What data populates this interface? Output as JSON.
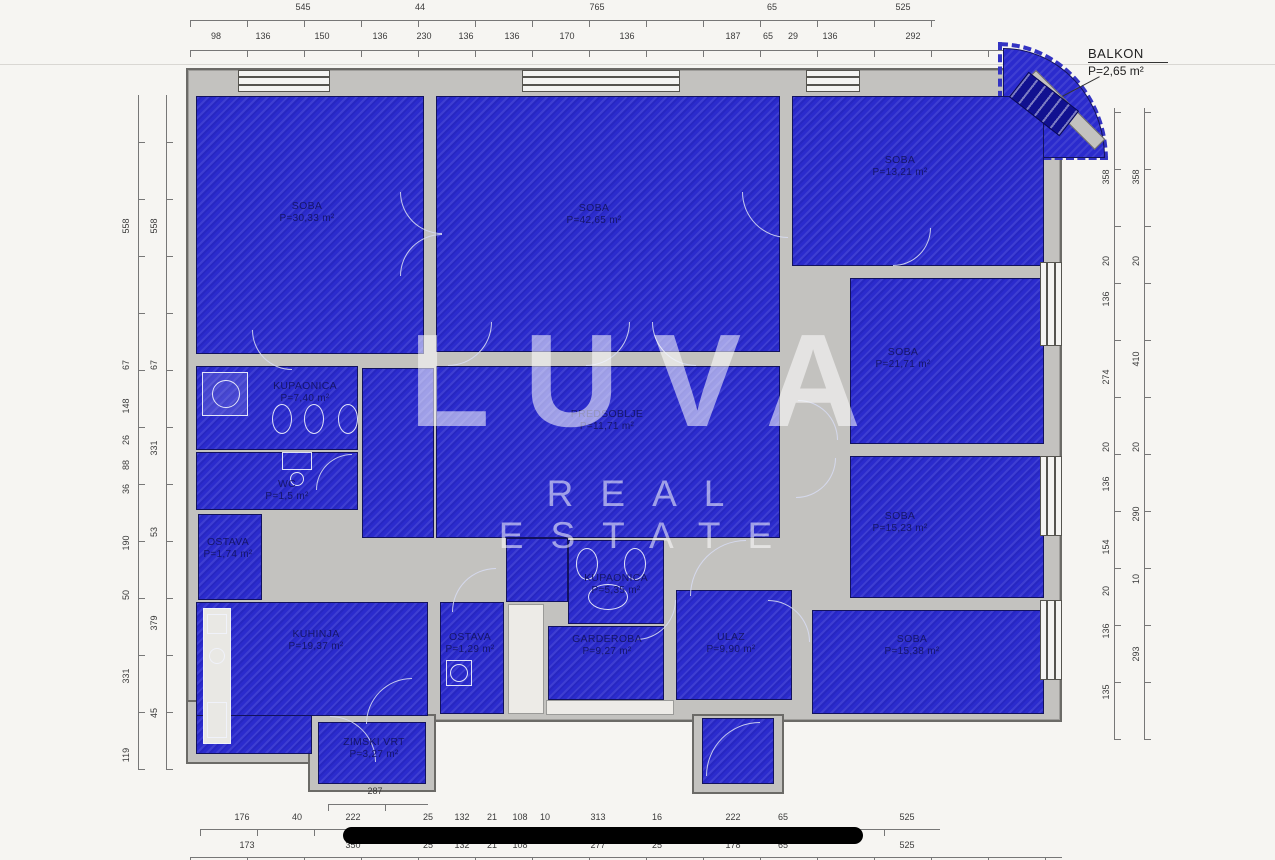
{
  "watermark": {
    "line1": "LUVA",
    "line2": "REAL ESTATE"
  },
  "balkon": {
    "name": "BALKON",
    "area": "P=2,65 m²"
  },
  "colors": {
    "room_blue": "#2b2bcd",
    "wall_gray": "#c3c2bf",
    "label_navy": "#15156a",
    "dim_text": "#3a3a3a",
    "bar_black": "#000000"
  },
  "rooms": [
    {
      "id": "soba-1",
      "name": "SOBA",
      "area": "P=30,33 m²",
      "x": 196,
      "y": 96,
      "w": 228,
      "h": 258,
      "lx": 307,
      "ly": 212
    },
    {
      "id": "soba-2",
      "name": "SOBA",
      "area": "P=42,65 m²",
      "x": 436,
      "y": 96,
      "w": 344,
      "h": 256,
      "lx": 594,
      "ly": 214
    },
    {
      "id": "soba-3",
      "name": "SOBA",
      "area": "P=13,21 m²",
      "x": 792,
      "y": 96,
      "w": 252,
      "h": 170,
      "lx": 900,
      "ly": 166
    },
    {
      "id": "soba-4",
      "name": "SOBA",
      "area": "P=21,71 m²",
      "x": 850,
      "y": 278,
      "w": 194,
      "h": 166,
      "lx": 903,
      "ly": 358
    },
    {
      "id": "soba-5",
      "name": "SOBA",
      "area": "P=15,23 m²",
      "x": 850,
      "y": 456,
      "w": 194,
      "h": 142,
      "lx": 900,
      "ly": 522
    },
    {
      "id": "soba-6",
      "name": "SOBA",
      "area": "P=15,38 m²",
      "x": 812,
      "y": 610,
      "w": 232,
      "h": 104,
      "lx": 912,
      "ly": 645
    },
    {
      "id": "predsoblje",
      "name": "PREDSOBLJE",
      "area": "P=11,71 m²",
      "x": 436,
      "y": 366,
      "w": 344,
      "h": 172,
      "lx": 607,
      "ly": 420
    },
    {
      "id": "kupaonica-1",
      "name": "KUPAONICA",
      "area": "P=7,40 m²",
      "x": 196,
      "y": 366,
      "w": 162,
      "h": 84,
      "lx": 305,
      "ly": 392
    },
    {
      "id": "wc",
      "name": "WC",
      "area": "P=1,5 m²",
      "x": 196,
      "y": 452,
      "w": 162,
      "h": 58,
      "lx": 287,
      "ly": 490
    },
    {
      "id": "ostava-1",
      "name": "OSTAVA",
      "area": "P=1,74 m²",
      "x": 198,
      "y": 514,
      "w": 64,
      "h": 86,
      "lx": 228,
      "ly": 548
    },
    {
      "id": "kuhinja",
      "name": "KUHINJA",
      "area": "P=19,37 m²",
      "x": 196,
      "y": 602,
      "w": 232,
      "h": 114,
      "lx": 316,
      "ly": 640
    },
    {
      "id": "zimski-vrt",
      "name": "ZIMSKI VRT",
      "area": "P=3,27 m²",
      "x": 318,
      "y": 722,
      "w": 108,
      "h": 62,
      "lx": 374,
      "ly": 748
    },
    {
      "id": "ostava-2",
      "name": "OSTAVA",
      "area": "P=1,29 m²",
      "x": 440,
      "y": 602,
      "w": 64,
      "h": 112,
      "lx": 470,
      "ly": 643
    },
    {
      "id": "kupaonica-2",
      "name": "KUPAONICA",
      "area": "P=5,35 m²",
      "x": 568,
      "y": 540,
      "w": 96,
      "h": 84,
      "lx": 616,
      "ly": 584
    },
    {
      "id": "garderoba",
      "name": "GARDEROBA",
      "area": "P=9,27 m²",
      "x": 548,
      "y": 626,
      "w": 116,
      "h": 74,
      "lx": 607,
      "ly": 645
    },
    {
      "id": "ulaz",
      "name": "ULAZ",
      "area": "P=9,90 m²",
      "x": 676,
      "y": 590,
      "w": 116,
      "h": 110,
      "lx": 731,
      "ly": 643
    }
  ],
  "annexes": [
    {
      "x": 196,
      "y": 602,
      "w": 116,
      "h": 152
    },
    {
      "x": 702,
      "y": 718,
      "w": 72,
      "h": 66
    },
    {
      "x": 362,
      "y": 368,
      "w": 72,
      "h": 170
    },
    {
      "x": 506,
      "y": 538,
      "w": 62,
      "h": 64
    }
  ],
  "wall_patches": [
    {
      "x": 186,
      "y": 700,
      "w": 134,
      "h": 64
    },
    {
      "x": 308,
      "y": 714,
      "w": 128,
      "h": 78
    },
    {
      "x": 692,
      "y": 714,
      "w": 92,
      "h": 80
    }
  ],
  "white_patches": [
    {
      "x": 508,
      "y": 604,
      "w": 36,
      "h": 110
    },
    {
      "x": 546,
      "y": 700,
      "w": 128,
      "h": 15
    }
  ],
  "windows": [
    {
      "o": "h",
      "x": 238,
      "y": 70,
      "w": 92,
      "h": 22
    },
    {
      "o": "h",
      "x": 522,
      "y": 70,
      "w": 158,
      "h": 22
    },
    {
      "o": "h",
      "x": 806,
      "y": 70,
      "w": 54,
      "h": 22
    },
    {
      "o": "v",
      "x": 1040,
      "y": 262,
      "w": 22,
      "h": 84
    },
    {
      "o": "v",
      "x": 1040,
      "y": 456,
      "w": 22,
      "h": 80
    },
    {
      "o": "v",
      "x": 1040,
      "y": 600,
      "w": 22,
      "h": 80
    }
  ],
  "doors": [
    {
      "x": 400,
      "y": 192,
      "s": 42,
      "q": "bl"
    },
    {
      "x": 400,
      "y": 234,
      "s": 42,
      "q": "tl"
    },
    {
      "x": 448,
      "y": 322,
      "s": 44,
      "q": "br"
    },
    {
      "x": 586,
      "y": 322,
      "s": 44,
      "q": "br"
    },
    {
      "x": 652,
      "y": 322,
      "s": 44,
      "q": "bl"
    },
    {
      "x": 742,
      "y": 192,
      "s": 46,
      "q": "bl"
    },
    {
      "x": 893,
      "y": 228,
      "s": 38,
      "q": "br"
    },
    {
      "x": 798,
      "y": 400,
      "s": 40,
      "q": "tr"
    },
    {
      "x": 796,
      "y": 458,
      "s": 40,
      "q": "br"
    },
    {
      "x": 690,
      "y": 540,
      "s": 56,
      "q": "tl"
    },
    {
      "x": 768,
      "y": 600,
      "s": 42,
      "q": "tr"
    },
    {
      "x": 636,
      "y": 600,
      "s": 40,
      "q": "br"
    },
    {
      "x": 452,
      "y": 568,
      "s": 44,
      "q": "tl"
    },
    {
      "x": 252,
      "y": 330,
      "s": 40,
      "q": "bl"
    },
    {
      "x": 316,
      "y": 454,
      "s": 36,
      "q": "tl"
    },
    {
      "x": 366,
      "y": 678,
      "s": 46,
      "q": "tl"
    },
    {
      "x": 330,
      "y": 716,
      "s": 46,
      "q": "tr"
    },
    {
      "x": 706,
      "y": 722,
      "s": 54,
      "q": "tl"
    }
  ],
  "fixtures": [
    {
      "t": "r",
      "x": 202,
      "y": 372,
      "w": 46,
      "h": 44,
      "f": "rgba(235,235,245,0.15)"
    },
    {
      "t": "c",
      "x": 212,
      "y": 380,
      "w": 28,
      "h": 28
    },
    {
      "t": "o",
      "x": 272,
      "y": 404,
      "w": 20,
      "h": 30
    },
    {
      "t": "o",
      "x": 304,
      "y": 404,
      "w": 20,
      "h": 30
    },
    {
      "t": "o",
      "x": 338,
      "y": 404,
      "w": 20,
      "h": 30
    },
    {
      "t": "r",
      "x": 282,
      "y": 452,
      "w": 30,
      "h": 18
    },
    {
      "t": "c",
      "x": 290,
      "y": 472,
      "w": 14,
      "h": 14
    },
    {
      "t": "o",
      "x": 576,
      "y": 548,
      "w": 22,
      "h": 32
    },
    {
      "t": "o",
      "x": 624,
      "y": 548,
      "w": 22,
      "h": 32
    },
    {
      "t": "o",
      "x": 588,
      "y": 584,
      "w": 40,
      "h": 26
    },
    {
      "t": "r",
      "x": 446,
      "y": 660,
      "w": 26,
      "h": 26
    },
    {
      "t": "c",
      "x": 450,
      "y": 664,
      "w": 18,
      "h": 18
    },
    {
      "t": "r",
      "x": 203,
      "y": 608,
      "w": 28,
      "h": 136,
      "f": "#e9e8e4"
    },
    {
      "t": "r",
      "x": 207,
      "y": 614,
      "w": 20,
      "h": 20,
      "f": "none"
    },
    {
      "t": "c",
      "x": 209,
      "y": 648,
      "w": 16,
      "h": 16
    },
    {
      "t": "r",
      "x": 207,
      "y": 702,
      "w": 20,
      "h": 36
    }
  ],
  "dim_lines": [
    {
      "o": "h",
      "x": 190,
      "y": 20,
      "len": 745
    },
    {
      "o": "h",
      "x": 190,
      "y": 50,
      "len": 815
    },
    {
      "o": "h",
      "x": 200,
      "y": 829,
      "len": 740
    },
    {
      "o": "h",
      "x": 190,
      "y": 857,
      "len": 872
    },
    {
      "o": "h",
      "x": 328,
      "y": 804,
      "len": 100
    },
    {
      "o": "v",
      "x": 138,
      "y": 95,
      "len": 675
    },
    {
      "o": "v",
      "x": 166,
      "y": 95,
      "len": 675
    },
    {
      "o": "v",
      "x": 1114,
      "y": 108,
      "len": 632
    },
    {
      "o": "v",
      "x": 1144,
      "y": 108,
      "len": 632
    }
  ],
  "dimensions": {
    "top_outer": {
      "y": 8,
      "labels": [
        {
          "v": "545",
          "x": 303
        },
        {
          "v": "44",
          "x": 420
        },
        {
          "v": "765",
          "x": 597
        },
        {
          "v": "65",
          "x": 772
        },
        {
          "v": "525",
          "x": 903
        }
      ]
    },
    "top_inner": {
      "y": 37,
      "labels": [
        {
          "v": "98",
          "x": 216
        },
        {
          "v": "136",
          "x": 263
        },
        {
          "v": "150",
          "x": 322
        },
        {
          "v": "136",
          "x": 380
        },
        {
          "v": "230",
          "x": 424
        },
        {
          "v": "136",
          "x": 466
        },
        {
          "v": "136",
          "x": 512
        },
        {
          "v": "170",
          "x": 567
        },
        {
          "v": "136",
          "x": 627
        },
        {
          "v": "187",
          "x": 733
        },
        {
          "v": "65",
          "x": 768
        },
        {
          "v": "29",
          "x": 793
        },
        {
          "v": "136",
          "x": 830
        },
        {
          "v": "292",
          "x": 913
        }
      ]
    },
    "bottom_upper": {
      "y": 818,
      "labels": [
        {
          "v": "176",
          "x": 242
        },
        {
          "v": "40",
          "x": 297
        },
        {
          "v": "222",
          "x": 353
        },
        {
          "v": "25",
          "x": 428
        },
        {
          "v": "132",
          "x": 462
        },
        {
          "v": "21",
          "x": 492
        },
        {
          "v": "108",
          "x": 520
        },
        {
          "v": "10",
          "x": 545
        },
        {
          "v": "313",
          "x": 598
        },
        {
          "v": "16",
          "x": 657
        },
        {
          "v": "222",
          "x": 733
        },
        {
          "v": "65",
          "x": 783
        },
        {
          "v": "525",
          "x": 907
        }
      ]
    },
    "bottom_lower": {
      "y": 846,
      "labels": [
        {
          "v": "173",
          "x": 247
        },
        {
          "v": "350",
          "x": 353
        },
        {
          "v": "25",
          "x": 428
        },
        {
          "v": "132",
          "x": 462
        },
        {
          "v": "21",
          "x": 492
        },
        {
          "v": "108",
          "x": 520
        },
        {
          "v": "277",
          "x": 598
        },
        {
          "v": "25",
          "x": 657
        },
        {
          "v": "178",
          "x": 733
        },
        {
          "v": "65",
          "x": 783
        },
        {
          "v": "525",
          "x": 907
        }
      ]
    },
    "left_outer": {
      "x": 126,
      "labels": [
        {
          "v": "558",
          "y": 227
        },
        {
          "v": "67",
          "y": 366
        },
        {
          "v": "148",
          "y": 407
        },
        {
          "v": "26",
          "y": 441
        },
        {
          "v": "88",
          "y": 466
        },
        {
          "v": "36",
          "y": 490
        },
        {
          "v": "190",
          "y": 544
        },
        {
          "v": "50",
          "y": 596
        },
        {
          "v": "331",
          "y": 677
        },
        {
          "v": "119",
          "y": 756
        }
      ]
    },
    "left_inner": {
      "x": 154,
      "labels": [
        {
          "v": "558",
          "y": 227
        },
        {
          "v": "67",
          "y": 366
        },
        {
          "v": "331",
          "y": 449
        },
        {
          "v": "53",
          "y": 533
        },
        {
          "v": "379",
          "y": 624
        },
        {
          "v": "45",
          "y": 714
        }
      ]
    },
    "right_inner": {
      "x": 1106,
      "labels": [
        {
          "v": "358",
          "y": 178
        },
        {
          "v": "20",
          "y": 262
        },
        {
          "v": "136",
          "y": 300
        },
        {
          "v": "274",
          "y": 378
        },
        {
          "v": "20",
          "y": 448
        },
        {
          "v": "136",
          "y": 485
        },
        {
          "v": "154",
          "y": 548
        },
        {
          "v": "20",
          "y": 592
        },
        {
          "v": "136",
          "y": 632
        },
        {
          "v": "135",
          "y": 693
        }
      ]
    },
    "right_outer": {
      "x": 1136,
      "labels": [
        {
          "v": "358",
          "y": 178
        },
        {
          "v": "20",
          "y": 262
        },
        {
          "v": "410",
          "y": 360
        },
        {
          "v": "20",
          "y": 448
        },
        {
          "v": "290",
          "y": 515
        },
        {
          "v": "10",
          "y": 580
        },
        {
          "v": "293",
          "y": 655
        }
      ]
    },
    "interior": [
      {
        "v": "287",
        "x": 375,
        "y": 792
      }
    ]
  }
}
